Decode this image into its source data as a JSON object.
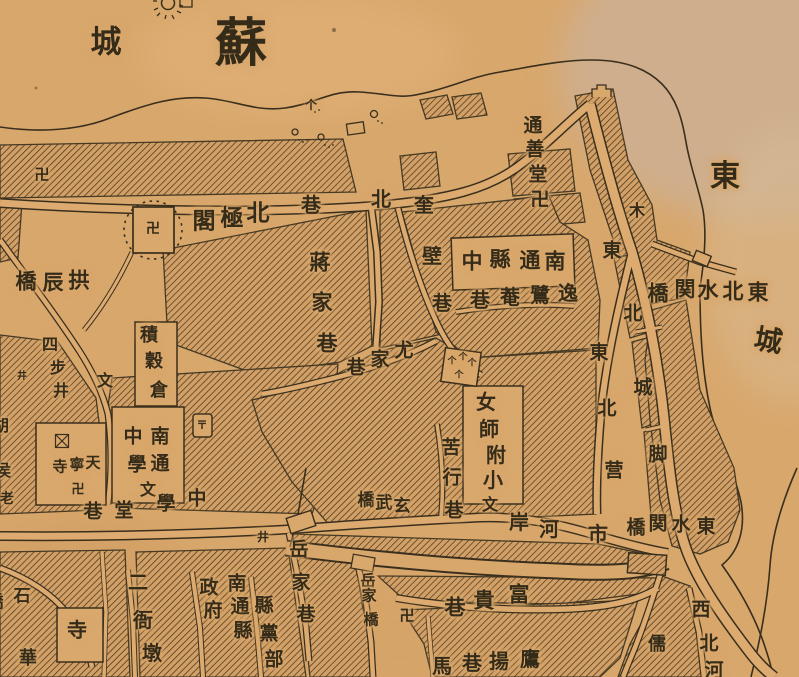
{
  "map": {
    "kind": "historical-city-map",
    "colors": {
      "paper": "#d8a76c",
      "paper_light": "#e2b279",
      "ink": "#3a2f1d",
      "hatch": "#4a3a22",
      "wash": "#c9b4a4"
    },
    "labels": [
      {
        "name": "area-label-su",
        "reading": "蘇",
        "size": 52,
        "cls": "xl",
        "chars": [
          {
            "c": "蘇",
            "x": 241,
            "y": 45
          }
        ]
      },
      {
        "name": "area-label-cheng-nw",
        "reading": "城",
        "size": 31,
        "chars": [
          {
            "c": "城",
            "x": 106,
            "y": 42
          }
        ]
      },
      {
        "name": "area-label-dong-east",
        "reading": "東",
        "size": 30,
        "chars": [
          {
            "c": "東",
            "x": 725,
            "y": 177
          }
        ]
      },
      {
        "name": "area-label-cheng-east",
        "reading": "城",
        "size": 28,
        "rot": 10,
        "chars": [
          {
            "c": "城",
            "x": 768,
            "y": 342
          }
        ]
      },
      {
        "name": "label-beijige",
        "reading": "北極閣",
        "size": 23,
        "chars": [
          {
            "c": "閣",
            "x": 204,
            "y": 221
          },
          {
            "c": "極",
            "x": 232,
            "y": 218
          },
          {
            "c": "北",
            "x": 258,
            "y": 213
          }
        ]
      },
      {
        "name": "label-gongchenqiao",
        "reading": "拱辰橋",
        "size": 21,
        "chars": [
          {
            "c": "橋",
            "x": 26,
            "y": 282
          },
          {
            "c": "辰",
            "x": 53,
            "y": 283
          },
          {
            "c": "拱",
            "x": 79,
            "y": 281
          }
        ]
      },
      {
        "name": "swastika-nw",
        "reading": "卍",
        "size": 15,
        "chars": [
          {
            "c": "卍",
            "x": 42,
            "y": 176
          }
        ]
      },
      {
        "name": "fort-swastika",
        "reading": "卍",
        "size": 14,
        "chars": [
          {
            "c": "卍",
            "x": 153,
            "y": 230
          }
        ]
      },
      {
        "name": "label-beixiang",
        "reading": "北巷",
        "size": 20,
        "chars": [
          {
            "c": "北",
            "x": 381,
            "y": 200
          },
          {
            "c": "巷",
            "x": 311,
            "y": 206
          }
        ]
      },
      {
        "name": "label-kuibixiang",
        "reading": "奎壁巷",
        "size": 20,
        "chars": [
          {
            "c": "奎",
            "x": 424,
            "y": 206
          },
          {
            "c": "壁",
            "x": 432,
            "y": 257
          },
          {
            "c": "巷",
            "x": 442,
            "y": 304
          }
        ]
      },
      {
        "name": "label-jiangjiaxiang",
        "reading": "蔣家巷",
        "size": 21,
        "chars": [
          {
            "c": "蔣",
            "x": 320,
            "y": 263
          },
          {
            "c": "家",
            "x": 322,
            "y": 303
          },
          {
            "c": "巷",
            "x": 327,
            "y": 344
          }
        ]
      },
      {
        "name": "label-youjiaxiang",
        "reading": "尤家巷",
        "size": 19,
        "chars": [
          {
            "c": "尤",
            "x": 404,
            "y": 351
          },
          {
            "c": "家",
            "x": 380,
            "y": 360
          },
          {
            "c": "巷",
            "x": 356,
            "y": 368
          }
        ]
      },
      {
        "name": "label-nantong-xianzhong",
        "reading": "南通縣中",
        "size": 21,
        "chars": [
          {
            "c": "中",
            "x": 472,
            "y": 262
          },
          {
            "c": "縣",
            "x": 500,
            "y": 260
          },
          {
            "c": "通",
            "x": 530,
            "y": 261
          },
          {
            "c": "南",
            "x": 555,
            "y": 262
          }
        ]
      },
      {
        "name": "label-yiluanxiang",
        "reading": "逸鷺菴巷",
        "size": 20,
        "chars": [
          {
            "c": "巷",
            "x": 480,
            "y": 301
          },
          {
            "c": "菴",
            "x": 510,
            "y": 298
          },
          {
            "c": "鷺",
            "x": 540,
            "y": 296
          },
          {
            "c": "逸",
            "x": 568,
            "y": 294
          }
        ]
      },
      {
        "name": "label-tongshantang",
        "reading": "通善堂卍",
        "size": 19,
        "chars": [
          {
            "c": "通",
            "x": 533,
            "y": 126
          },
          {
            "c": "善",
            "x": 535,
            "y": 150
          },
          {
            "c": "堂",
            "x": 538,
            "y": 175
          },
          {
            "c": "卍",
            "x": 540,
            "y": 200
          }
        ]
      },
      {
        "name": "label-dongbeishuiguanqiao",
        "reading": "東北水関橋",
        "size": 21,
        "chars": [
          {
            "c": "橋",
            "x": 658,
            "y": 294
          },
          {
            "c": "関",
            "x": 685,
            "y": 290
          },
          {
            "c": "水",
            "x": 708,
            "y": 291
          },
          {
            "c": "北",
            "x": 733,
            "y": 292
          },
          {
            "c": "東",
            "x": 758,
            "y": 293
          }
        ]
      },
      {
        "name": "label-mu",
        "reading": "木",
        "size": 16,
        "chars": [
          {
            "c": "木",
            "x": 637,
            "y": 212
          }
        ]
      },
      {
        "name": "label-dongbei-road",
        "reading": "東北",
        "size": 19,
        "chars": [
          {
            "c": "東",
            "x": 612,
            "y": 251
          },
          {
            "c": "北",
            "x": 633,
            "y": 314
          }
        ]
      },
      {
        "name": "label-dongbeiying",
        "reading": "東北营",
        "size": 19,
        "chars": [
          {
            "c": "東",
            "x": 599,
            "y": 353
          },
          {
            "c": "北",
            "x": 607,
            "y": 409
          },
          {
            "c": "营",
            "x": 614,
            "y": 471
          }
        ]
      },
      {
        "name": "label-chengjiao",
        "reading": "城脚",
        "size": 19,
        "chars": [
          {
            "c": "城",
            "x": 643,
            "y": 388
          },
          {
            "c": "脚",
            "x": 658,
            "y": 455
          }
        ]
      },
      {
        "name": "label-nvshifuxiao",
        "reading": "女師附小",
        "size": 20,
        "chars": [
          {
            "c": "女",
            "x": 486,
            "y": 403
          },
          {
            "c": "師",
            "x": 489,
            "y": 430
          },
          {
            "c": "附",
            "x": 496,
            "y": 456
          },
          {
            "c": "小",
            "x": 493,
            "y": 481
          }
        ]
      },
      {
        "name": "marker-wen-1",
        "reading": "文",
        "size": 16,
        "chars": [
          {
            "c": "文",
            "x": 490,
            "y": 506
          }
        ]
      },
      {
        "name": "marker-wen-2",
        "reading": "文",
        "size": 16,
        "chars": [
          {
            "c": "文",
            "x": 148,
            "y": 491
          }
        ]
      },
      {
        "name": "marker-wen-3",
        "reading": "文",
        "size": 16,
        "chars": [
          {
            "c": "文",
            "x": 105,
            "y": 382
          }
        ]
      },
      {
        "name": "label-kuxingxiang",
        "reading": "苦行巷",
        "size": 19,
        "chars": [
          {
            "c": "苦",
            "x": 451,
            "y": 448
          },
          {
            "c": "行",
            "x": 452,
            "y": 478
          },
          {
            "c": "巷",
            "x": 454,
            "y": 511
          }
        ]
      },
      {
        "name": "label-xuanwuqiao",
        "reading": "玄武橋",
        "size": 17,
        "chars": [
          {
            "c": "橋",
            "x": 366,
            "y": 500
          },
          {
            "c": "武",
            "x": 384,
            "y": 503
          },
          {
            "c": "玄",
            "x": 402,
            "y": 506
          }
        ]
      },
      {
        "name": "label-shihean",
        "reading": "市河岸",
        "size": 20,
        "chars": [
          {
            "c": "岸",
            "x": 519,
            "y": 523
          },
          {
            "c": "河",
            "x": 549,
            "y": 530
          },
          {
            "c": "市",
            "x": 598,
            "y": 535
          }
        ]
      },
      {
        "name": "label-zhongxuetangxiang",
        "reading": "中學堂巷",
        "size": 19,
        "chars": [
          {
            "c": "中",
            "x": 197,
            "y": 499
          },
          {
            "c": "學",
            "x": 166,
            "y": 504
          },
          {
            "c": "堂",
            "x": 124,
            "y": 511
          },
          {
            "c": "巷",
            "x": 93,
            "y": 512
          }
        ]
      },
      {
        "name": "label-nantongzhongxue",
        "reading": "南通中學",
        "size": 19,
        "chars": [
          {
            "c": "南",
            "x": 160,
            "y": 437
          },
          {
            "c": "通",
            "x": 160,
            "y": 464
          },
          {
            "c": "中",
            "x": 133,
            "y": 437
          },
          {
            "c": "學",
            "x": 137,
            "y": 465
          }
        ]
      },
      {
        "name": "label-tianningsi",
        "reading": "天寧寺",
        "size": 15,
        "chars": [
          {
            "c": "寺",
            "x": 60,
            "y": 468
          },
          {
            "c": "寧",
            "x": 77,
            "y": 466
          },
          {
            "c": "天",
            "x": 93,
            "y": 464
          }
        ]
      },
      {
        "name": "tianningsi-swastika",
        "reading": "卍",
        "size": 13,
        "chars": [
          {
            "c": "卍",
            "x": 78,
            "y": 489
          }
        ]
      },
      {
        "name": "label-jigucang",
        "reading": "積穀倉",
        "size": 18,
        "chars": [
          {
            "c": "積",
            "x": 149,
            "y": 335
          },
          {
            "c": "穀",
            "x": 154,
            "y": 361
          },
          {
            "c": "倉",
            "x": 159,
            "y": 390
          }
        ]
      },
      {
        "name": "label-sibujing",
        "reading": "四步井",
        "size": 16,
        "chars": [
          {
            "c": "四",
            "x": 50,
            "y": 346
          },
          {
            "c": "步",
            "x": 58,
            "y": 369
          },
          {
            "c": "井",
            "x": 61,
            "y": 392
          }
        ]
      },
      {
        "name": "well-marker-1",
        "reading": "井",
        "size": 10,
        "chars": [
          {
            "c": "井",
            "x": 22,
            "y": 377
          }
        ]
      },
      {
        "name": "well-marker-2",
        "reading": "井",
        "size": 12,
        "chars": [
          {
            "c": "井",
            "x": 263,
            "y": 537
          }
        ]
      },
      {
        "name": "edge-label-hu",
        "reading": "胡",
        "size": 16,
        "chars": [
          {
            "c": "胡",
            "x": 1,
            "y": 427
          }
        ]
      },
      {
        "name": "edge-label-hou",
        "reading": "侯",
        "size": 16,
        "chars": [
          {
            "c": "侯",
            "x": 3,
            "y": 472
          }
        ]
      },
      {
        "name": "edge-label-lao",
        "reading": "老",
        "size": 14,
        "chars": [
          {
            "c": "老",
            "x": 7,
            "y": 500
          }
        ]
      },
      {
        "name": "label-shiqiao",
        "reading": "石橋",
        "size": 17,
        "chars": [
          {
            "c": "石",
            "x": 22,
            "y": 596
          },
          {
            "c": "橋",
            "x": -5,
            "y": 602
          }
        ]
      },
      {
        "name": "label-si-temple",
        "reading": "寺",
        "size": 20,
        "chars": [
          {
            "c": "寺",
            "x": 77,
            "y": 631
          }
        ]
      },
      {
        "name": "edge-label-hua",
        "reading": "華",
        "size": 18,
        "chars": [
          {
            "c": "華",
            "x": 28,
            "y": 658
          }
        ]
      },
      {
        "name": "label-eryadun",
        "reading": "二衙墩",
        "size": 20,
        "chars": [
          {
            "c": "二",
            "x": 138,
            "y": 583
          },
          {
            "c": "衙",
            "x": 143,
            "y": 621
          },
          {
            "c": "墩",
            "x": 152,
            "y": 654
          }
        ]
      },
      {
        "name": "label-nantongxian-zhengfu",
        "reading": "南通縣政府",
        "size": 19,
        "chars": [
          {
            "c": "南",
            "x": 237,
            "y": 584
          },
          {
            "c": "通",
            "x": 240,
            "y": 607
          },
          {
            "c": "縣",
            "x": 243,
            "y": 631
          },
          {
            "c": "政",
            "x": 209,
            "y": 588
          },
          {
            "c": "府",
            "x": 213,
            "y": 611
          }
        ]
      },
      {
        "name": "label-xiandangbu",
        "reading": "縣黨部",
        "size": 19,
        "chars": [
          {
            "c": "縣",
            "x": 264,
            "y": 606
          },
          {
            "c": "黨",
            "x": 269,
            "y": 634
          },
          {
            "c": "部",
            "x": 274,
            "y": 660
          }
        ]
      },
      {
        "name": "label-yuejiaxiang",
        "reading": "岳家巷",
        "size": 19,
        "chars": [
          {
            "c": "岳",
            "x": 299,
            "y": 550
          },
          {
            "c": "家",
            "x": 301,
            "y": 583
          },
          {
            "c": "巷",
            "x": 306,
            "y": 615
          }
        ]
      },
      {
        "name": "label-yuejiaqiao",
        "reading": "岳家橋",
        "size": 15,
        "chars": [
          {
            "c": "岳",
            "x": 368,
            "y": 582
          },
          {
            "c": "家",
            "x": 369,
            "y": 597
          },
          {
            "c": "橋",
            "x": 371,
            "y": 621
          }
        ]
      },
      {
        "name": "swastika-fugui",
        "reading": "卍",
        "size": 15,
        "chars": [
          {
            "c": "卍",
            "x": 407,
            "y": 617
          }
        ]
      },
      {
        "name": "label-fuguixiang",
        "reading": "富貴巷",
        "size": 21,
        "chars": [
          {
            "c": "巷",
            "x": 455,
            "y": 608
          },
          {
            "c": "貴",
            "x": 484,
            "y": 601
          },
          {
            "c": "富",
            "x": 519,
            "y": 595
          }
        ]
      },
      {
        "name": "label-yingyangxiang",
        "reading": "鷹揚巷馬",
        "size": 20,
        "chars": [
          {
            "c": "馬",
            "x": 442,
            "y": 667
          },
          {
            "c": "巷",
            "x": 472,
            "y": 664
          },
          {
            "c": "揚",
            "x": 499,
            "y": 662
          },
          {
            "c": "鷹",
            "x": 530,
            "y": 660
          }
        ]
      },
      {
        "name": "label-ru",
        "reading": "儒",
        "size": 18,
        "chars": [
          {
            "c": "儒",
            "x": 657,
            "y": 644
          }
        ]
      },
      {
        "name": "label-xibeihe",
        "reading": "西北河",
        "size": 19,
        "chars": [
          {
            "c": "西",
            "x": 701,
            "y": 610
          },
          {
            "c": "北",
            "x": 709,
            "y": 644
          },
          {
            "c": "河",
            "x": 714,
            "y": 671
          }
        ]
      },
      {
        "name": "label-dongshuiguanqiao",
        "reading": "東水関橋",
        "size": 19,
        "chars": [
          {
            "c": "橋",
            "x": 636,
            "y": 528
          },
          {
            "c": "関",
            "x": 658,
            "y": 524
          },
          {
            "c": "水",
            "x": 681,
            "y": 525
          },
          {
            "c": "東",
            "x": 706,
            "y": 527
          }
        ]
      },
      {
        "name": "shield-mark-glyph",
        "reading": "〒",
        "size": 11,
        "chars": [
          {
            "c": "〒",
            "x": 202,
            "y": 426
          }
        ]
      },
      {
        "name": "treebox-trees",
        "reading": "个个个个",
        "size": 9,
        "chars": [
          {
            "c": "个",
            "x": 452,
            "y": 361
          },
          {
            "c": "个",
            "x": 463,
            "y": 357
          },
          {
            "c": "个",
            "x": 472,
            "y": 363
          },
          {
            "c": "个",
            "x": 459,
            "y": 375
          }
        ]
      },
      {
        "name": "shore-tree",
        "reading": "个",
        "size": 12,
        "chars": [
          {
            "c": "个",
            "x": 311,
            "y": 105
          }
        ]
      }
    ]
  }
}
